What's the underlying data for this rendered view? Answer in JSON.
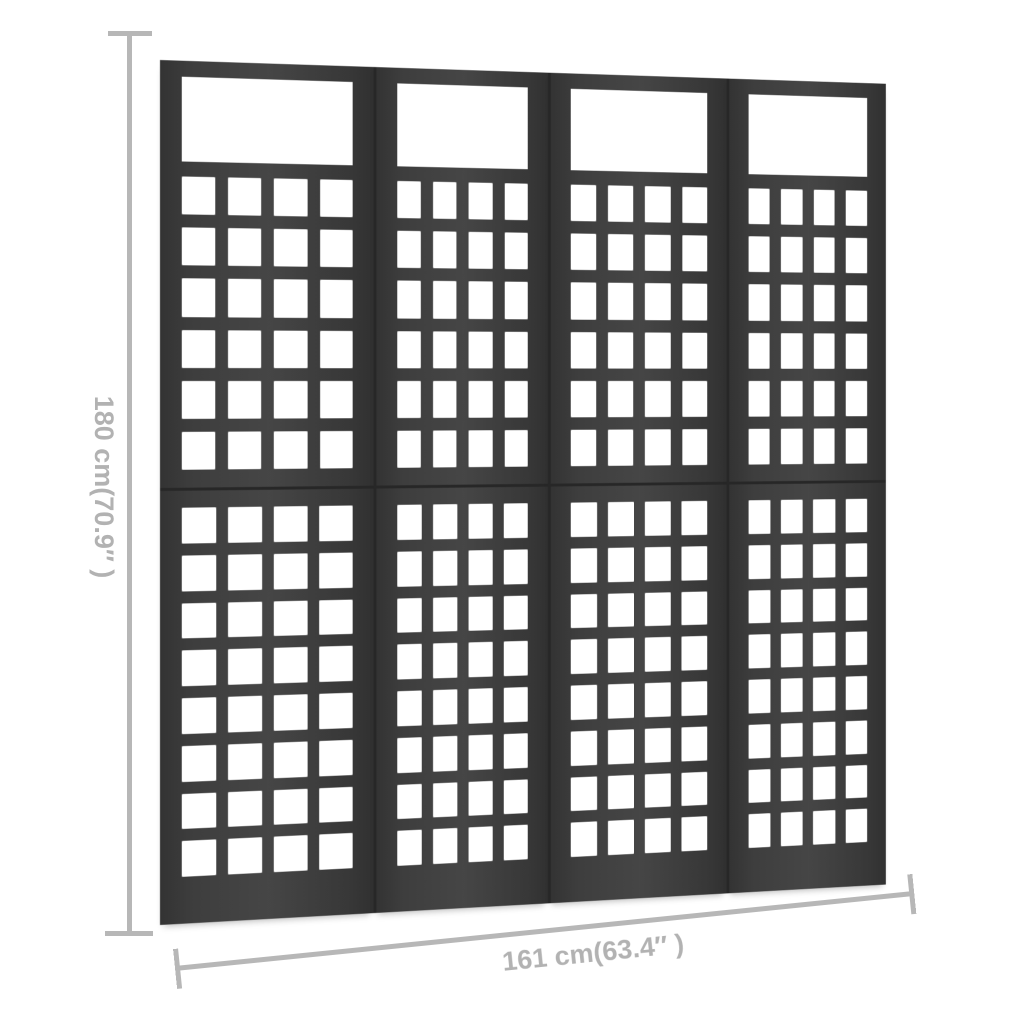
{
  "annotations": {
    "height_label": "180 cm(70.9″ )",
    "width_label": "161 cm(63.4″ )"
  },
  "structure": {
    "panels": 4,
    "columns_per_panel": 4,
    "upper_rows": 6,
    "lower_rows": 8,
    "panel_flex": [
      2.24,
      1.79,
      1.93,
      1.75
    ]
  },
  "colors": {
    "background": "#ffffff",
    "frame": "#3e3e3e",
    "frame_seam": "#272727",
    "cell": "#ffffff",
    "dimension_line": "#b7b7b7",
    "dimension_text": "#b2b2b2"
  }
}
